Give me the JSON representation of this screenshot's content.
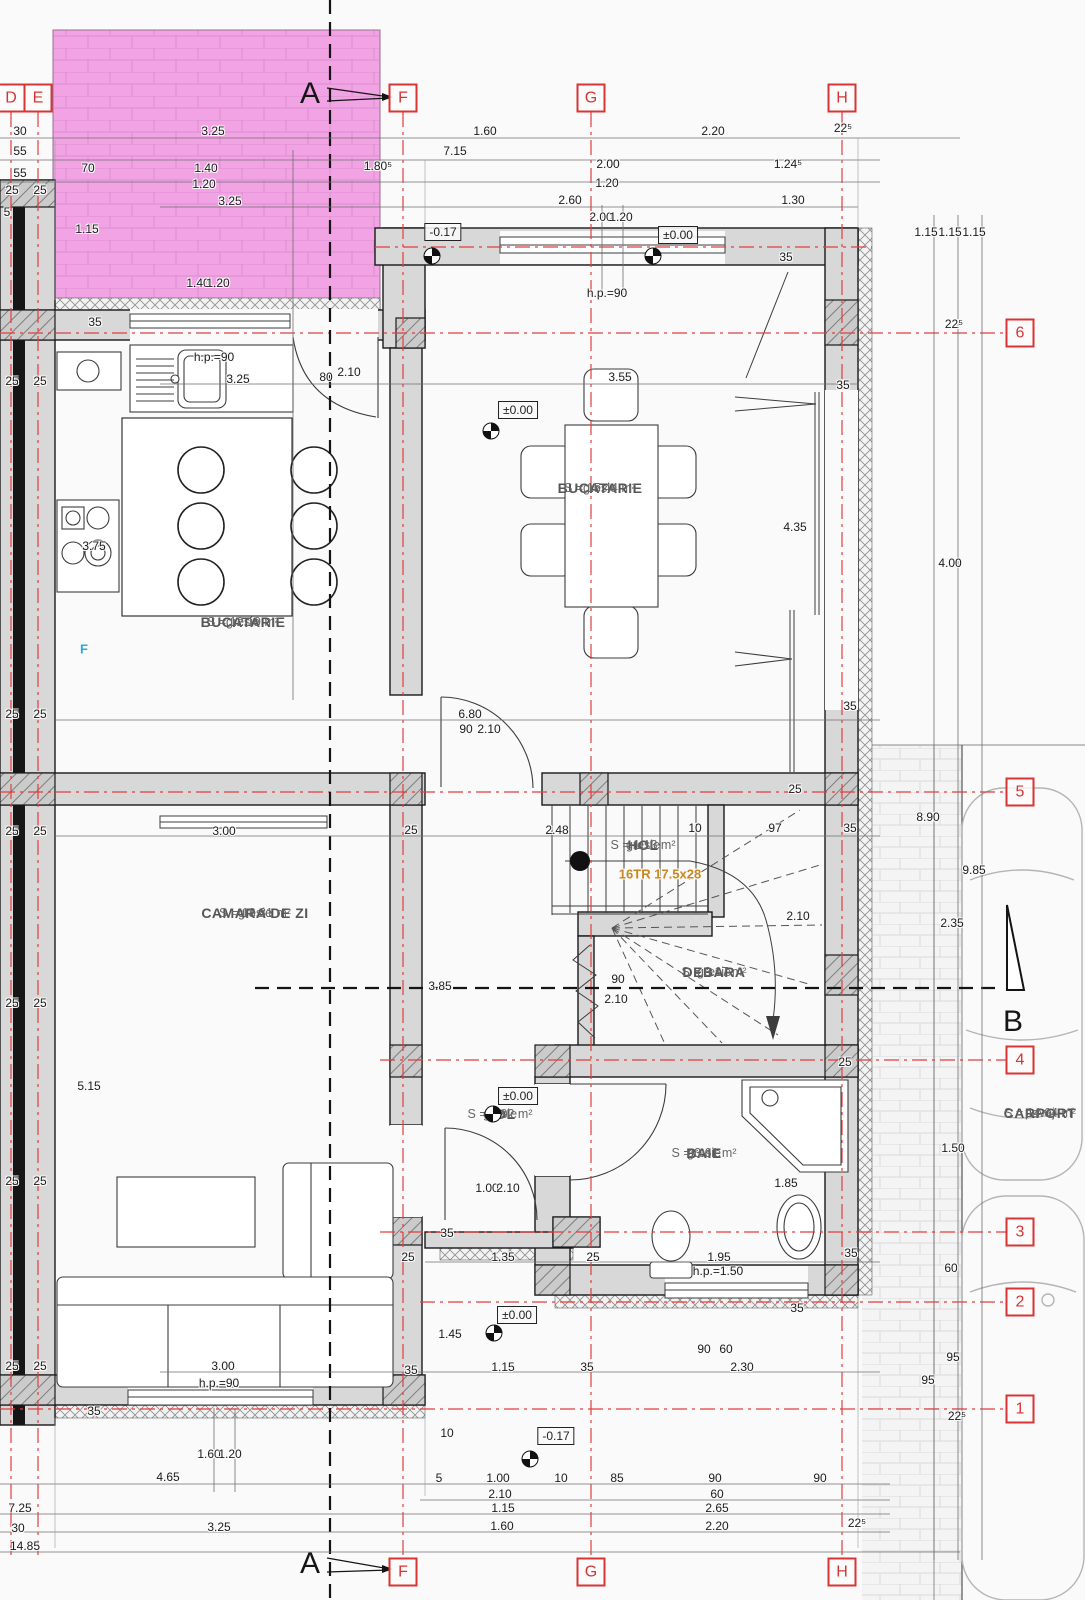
{
  "drawing": {
    "plan_type": "ground-floor architectural plan",
    "colors": {
      "axis_red": "#e23d3d",
      "marker_red": "#d83434",
      "wall_gray": "#d8d8d8",
      "terrace_pink": "#f1a3e3",
      "stair_note_orange": "#c9871d",
      "fridge_blue": "#2aa9e0"
    },
    "rooms": [
      {
        "name": "BUCATARIE",
        "finish": "gresie",
        "area": "S = 12.19 m²",
        "x": 243,
        "y": 622
      },
      {
        "name": "BUCATARIE",
        "finish": "gresie",
        "area": "S = 15.44 m²",
        "x": 600,
        "y": 488
      },
      {
        "name": "CAMARA DE ZI",
        "finish": "gresie",
        "area": "S = 18.81 m²",
        "x": 255,
        "y": 913
      },
      {
        "name": "HOL",
        "finish": "gresie",
        "area": "S = 1.13 m²",
        "x": 643,
        "y": 845
      },
      {
        "name": "DEBARA",
        "finish": "gresie",
        "area": "S = 3.17 m²",
        "x": 714,
        "y": 972
      },
      {
        "name": "HOL",
        "finish": "gresie",
        "area": "S = 2.02 m²",
        "x": 500,
        "y": 1114
      },
      {
        "name": "BAIE",
        "finish": "gresie",
        "area": "S = 3.61 m²",
        "x": 704,
        "y": 1153
      },
      {
        "name": "CARPORT",
        "finish": "pavaj",
        "area": "S = 14.64 m²",
        "x": 1040,
        "y": 1113
      }
    ],
    "axes": {
      "top": [
        {
          "label": "D",
          "x": 11,
          "y": 98
        },
        {
          "label": "E",
          "x": 38,
          "y": 98
        },
        {
          "label": "F",
          "x": 403,
          "y": 98
        },
        {
          "label": "G",
          "x": 591,
          "y": 98
        },
        {
          "label": "H",
          "x": 842,
          "y": 98
        }
      ],
      "bottom": [
        {
          "label": "F",
          "x": 403,
          "y": 1572
        },
        {
          "label": "G",
          "x": 591,
          "y": 1572
        },
        {
          "label": "H",
          "x": 842,
          "y": 1572
        }
      ],
      "right": [
        {
          "label": "6",
          "x": 1020,
          "y": 333
        },
        {
          "label": "5",
          "x": 1020,
          "y": 792
        },
        {
          "label": "4",
          "x": 1020,
          "y": 1060
        },
        {
          "label": "3",
          "x": 1020,
          "y": 1232
        },
        {
          "label": "2",
          "x": 1020,
          "y": 1302
        },
        {
          "label": "1",
          "x": 1020,
          "y": 1409
        }
      ]
    },
    "sections": [
      {
        "label": "A",
        "x": 310,
        "y": 94
      },
      {
        "label": "A",
        "x": 310,
        "y": 1564
      },
      {
        "label": "B",
        "x": 1013,
        "y": 1022
      }
    ],
    "levels": [
      {
        "t": "-0.17",
        "bx": 443,
        "by": 232,
        "sx": 432,
        "sy": 256
      },
      {
        "t": "±0.00",
        "bx": 678,
        "by": 235,
        "sx": 653,
        "sy": 256
      },
      {
        "t": "±0.00",
        "bx": 518,
        "by": 410,
        "sx": 491,
        "sy": 431
      },
      {
        "t": "±0.00",
        "bx": 518,
        "by": 1096,
        "sx": 493,
        "sy": 1114
      },
      {
        "t": "±0.00",
        "bx": 517,
        "by": 1315,
        "sx": 494,
        "sy": 1333
      },
      {
        "t": "-0.17",
        "bx": 556,
        "by": 1436,
        "sx": 530,
        "sy": 1459
      }
    ],
    "dims_h": [
      {
        "t": "30",
        "x": 20,
        "y": 131
      },
      {
        "t": "3.25",
        "x": 213,
        "y": 131
      },
      {
        "t": "1.60",
        "x": 485,
        "y": 131
      },
      {
        "t": "2.20",
        "x": 713,
        "y": 131
      },
      {
        "t": "22⁵",
        "x": 843,
        "y": 128
      },
      {
        "t": "55",
        "x": 20,
        "y": 151
      },
      {
        "t": "7.15",
        "x": 455,
        "y": 151
      },
      {
        "t": "55",
        "x": 20,
        "y": 173
      },
      {
        "t": "70",
        "x": 88,
        "y": 168
      },
      {
        "t": "1.40",
        "x": 206,
        "y": 168
      },
      {
        "t": "1.80⁵",
        "x": 378,
        "y": 166
      },
      {
        "t": "2.00",
        "x": 608,
        "y": 164
      },
      {
        "t": "1.24⁵",
        "x": 788,
        "y": 164
      },
      {
        "t": "1.20",
        "x": 204,
        "y": 184
      },
      {
        "t": "1.20",
        "x": 607,
        "y": 183
      },
      {
        "t": "3.25",
        "x": 230,
        "y": 201
      },
      {
        "t": "2.60",
        "x": 570,
        "y": 200
      },
      {
        "t": "1.30",
        "x": 793,
        "y": 200
      },
      {
        "t": "25",
        "x": 12,
        "y": 190
      },
      {
        "t": "25",
        "x": 40,
        "y": 190
      },
      {
        "t": "5",
        "x": 7,
        "y": 212
      },
      {
        "t": "h.p.=90",
        "x": 607,
        "y": 293
      },
      {
        "t": "h.p.=90",
        "x": 214,
        "y": 357
      },
      {
        "t": "3.25",
        "x": 238,
        "y": 379
      },
      {
        "t": "3.55",
        "x": 620,
        "y": 377
      },
      {
        "t": "25",
        "x": 12,
        "y": 381
      },
      {
        "t": "25",
        "x": 40,
        "y": 381
      },
      {
        "t": "25",
        "x": 12,
        "y": 714
      },
      {
        "t": "25",
        "x": 40,
        "y": 714
      },
      {
        "t": "6.80",
        "x": 470,
        "y": 714
      },
      {
        "t": "35",
        "x": 850,
        "y": 706
      },
      {
        "t": "35",
        "x": 843,
        "y": 385
      },
      {
        "t": "2.48",
        "x": 557,
        "y": 830
      },
      {
        "t": "10",
        "x": 695,
        "y": 828
      },
      {
        "t": "97",
        "x": 775,
        "y": 828
      },
      {
        "t": "35",
        "x": 850,
        "y": 828
      },
      {
        "t": "3.00",
        "x": 224,
        "y": 831
      },
      {
        "t": "25",
        "x": 411,
        "y": 830
      },
      {
        "t": "25",
        "x": 12,
        "y": 831
      },
      {
        "t": "25",
        "x": 40,
        "y": 831
      },
      {
        "t": "25",
        "x": 12,
        "y": 1003
      },
      {
        "t": "25",
        "x": 40,
        "y": 1003
      },
      {
        "t": "90",
        "x": 618,
        "y": 979
      },
      {
        "t": "2.10",
        "x": 616,
        "y": 999
      },
      {
        "t": "1.35",
        "x": 503,
        "y": 1257
      },
      {
        "t": "25",
        "x": 408,
        "y": 1257
      },
      {
        "t": "25",
        "x": 593,
        "y": 1257
      },
      {
        "t": "1.95",
        "x": 719,
        "y": 1257
      },
      {
        "t": "h.p.=1.50",
        "x": 718,
        "y": 1271
      },
      {
        "t": "35",
        "x": 851,
        "y": 1253
      },
      {
        "t": "25",
        "x": 12,
        "y": 1181
      },
      {
        "t": "25",
        "x": 40,
        "y": 1181
      },
      {
        "t": "3.00",
        "x": 223,
        "y": 1366
      },
      {
        "t": "35",
        "x": 411,
        "y": 1370
      },
      {
        "t": "h.p.=90",
        "x": 219,
        "y": 1383
      },
      {
        "t": "25",
        "x": 12,
        "y": 1366
      },
      {
        "t": "25",
        "x": 40,
        "y": 1366
      },
      {
        "t": "1.15",
        "x": 503,
        "y": 1367
      },
      {
        "t": "35",
        "x": 587,
        "y": 1367
      },
      {
        "t": "2.30",
        "x": 742,
        "y": 1367
      },
      {
        "t": "5",
        "x": 439,
        "y": 1478
      },
      {
        "t": "1.00",
        "x": 498,
        "y": 1478
      },
      {
        "t": "10",
        "x": 561,
        "y": 1478
      },
      {
        "t": "85",
        "x": 617,
        "y": 1478
      },
      {
        "t": "90",
        "x": 715,
        "y": 1478
      },
      {
        "t": "90",
        "x": 820,
        "y": 1478
      },
      {
        "t": "2.10",
        "x": 500,
        "y": 1494
      },
      {
        "t": "60",
        "x": 717,
        "y": 1494
      },
      {
        "t": "1.15",
        "x": 503,
        "y": 1508
      },
      {
        "t": "2.65",
        "x": 717,
        "y": 1508
      },
      {
        "t": "1.60",
        "x": 502,
        "y": 1526
      },
      {
        "t": "2.20",
        "x": 717,
        "y": 1526
      },
      {
        "t": "22⁵",
        "x": 857,
        "y": 1523
      },
      {
        "t": "4.65",
        "x": 168,
        "y": 1477
      },
      {
        "t": "7.25",
        "x": 20,
        "y": 1508
      },
      {
        "t": "30",
        "x": 18,
        "y": 1528
      },
      {
        "t": "3.25",
        "x": 219,
        "y": 1527
      },
      {
        "t": "14.85",
        "x": 25,
        "y": 1546
      }
    ],
    "dims_v": [
      {
        "t": "1.15",
        "x": 87,
        "y": 229
      },
      {
        "t": "35",
        "x": 95,
        "y": 322
      },
      {
        "t": "1.40",
        "x": 198,
        "y": 283
      },
      {
        "t": "1.20",
        "x": 218,
        "y": 283
      },
      {
        "t": "3.75",
        "x": 94,
        "y": 546
      },
      {
        "t": "5.15",
        "x": 89,
        "y": 1086
      },
      {
        "t": "80",
        "x": 326,
        "y": 377
      },
      {
        "t": "2.10",
        "x": 349,
        "y": 372
      },
      {
        "t": "2.00",
        "x": 601,
        "y": 217
      },
      {
        "t": "1.20",
        "x": 621,
        "y": 217
      },
      {
        "t": "35",
        "x": 786,
        "y": 257
      },
      {
        "t": "90",
        "x": 466,
        "y": 729
      },
      {
        "t": "2.10",
        "x": 489,
        "y": 729
      },
      {
        "t": "25",
        "x": 795,
        "y": 789
      },
      {
        "t": "2.10",
        "x": 798,
        "y": 916
      },
      {
        "t": "3.85",
        "x": 440,
        "y": 986
      },
      {
        "t": "25",
        "x": 845,
        "y": 1062
      },
      {
        "t": "1.00",
        "x": 487,
        "y": 1188
      },
      {
        "t": "2.10",
        "x": 508,
        "y": 1188
      },
      {
        "t": "1.85",
        "x": 786,
        "y": 1183
      },
      {
        "t": "35",
        "x": 447,
        "y": 1233
      },
      {
        "t": "1.45",
        "x": 450,
        "y": 1334
      },
      {
        "t": "10",
        "x": 447,
        "y": 1433
      },
      {
        "t": "35",
        "x": 94,
        "y": 1411
      },
      {
        "t": "1.60",
        "x": 209,
        "y": 1454
      },
      {
        "t": "1.20",
        "x": 230,
        "y": 1454
      },
      {
        "t": "90",
        "x": 704,
        "y": 1349
      },
      {
        "t": "60",
        "x": 726,
        "y": 1349
      },
      {
        "t": "35",
        "x": 797,
        "y": 1308
      },
      {
        "t": "1.15",
        "x": 926,
        "y": 232
      },
      {
        "t": "1.15",
        "x": 950,
        "y": 232
      },
      {
        "t": "1.15",
        "x": 974,
        "y": 232
      },
      {
        "t": "22⁵",
        "x": 954,
        "y": 324
      },
      {
        "t": "4.00",
        "x": 950,
        "y": 563
      },
      {
        "t": "4.35",
        "x": 795,
        "y": 527
      },
      {
        "t": "8.90",
        "x": 928,
        "y": 817
      },
      {
        "t": "9.85",
        "x": 974,
        "y": 870
      },
      {
        "t": "2.35",
        "x": 952,
        "y": 923
      },
      {
        "t": "1.50",
        "x": 953,
        "y": 1148
      },
      {
        "t": "60",
        "x": 951,
        "y": 1268
      },
      {
        "t": "95",
        "x": 953,
        "y": 1357
      },
      {
        "t": "95",
        "x": 928,
        "y": 1380
      },
      {
        "t": "22⁵",
        "x": 957,
        "y": 1416
      }
    ],
    "specials": [
      {
        "t": "16TR 17.5x28",
        "x": 660,
        "y": 874,
        "color": "#c9871d"
      },
      {
        "t": "F",
        "x": 84,
        "y": 649,
        "color": "#2aa9e0"
      }
    ]
  }
}
